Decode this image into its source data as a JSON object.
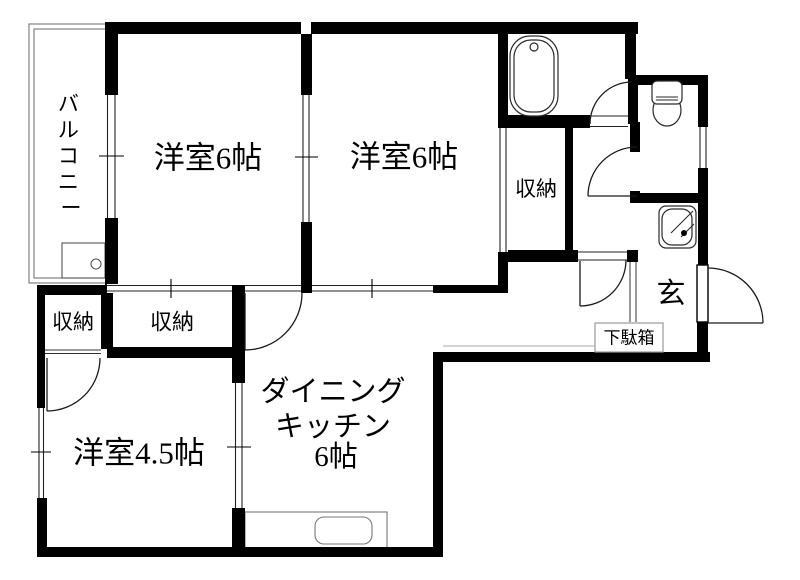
{
  "rooms": {
    "balcony": {
      "label": "バルコニー",
      "chars": [
        "バ",
        "ル",
        "コ",
        "ニ",
        "ー"
      ]
    },
    "western_room_left": {
      "label": "洋室6帖"
    },
    "western_room_right": {
      "label": "洋室6帖"
    },
    "western_room_45": {
      "label": "洋室4.5帖"
    },
    "dining_kitchen": {
      "label": "ダイニングキッチン6帖",
      "lines": [
        "ダイニング",
        "キッチン",
        "6帖"
      ]
    },
    "entrance": {
      "label": "玄"
    }
  },
  "closets": {
    "left_small": {
      "label": "収納"
    },
    "left_wide": {
      "label": "収納"
    },
    "right": {
      "label": "収納"
    }
  },
  "fixtures": {
    "shoe_cabinet": {
      "label": "下駄箱",
      "icon": "shoe-cabinet-icon"
    },
    "bathtub": {
      "icon": "bathtub-icon"
    },
    "toilet": {
      "icon": "toilet-icon"
    },
    "washbasin": {
      "icon": "washbasin-icon"
    },
    "kitchen_sink": {
      "icon": "kitchen-sink-icon"
    },
    "washing_machine_pan": {
      "icon": "washing-machine-pan-icon"
    },
    "front_door": {
      "icon": "door-swing-icon"
    }
  },
  "colors": {
    "wall": "#000000",
    "background": "#ffffff",
    "fixture_line": "#2a2a2a",
    "thin_line": "#888888"
  }
}
